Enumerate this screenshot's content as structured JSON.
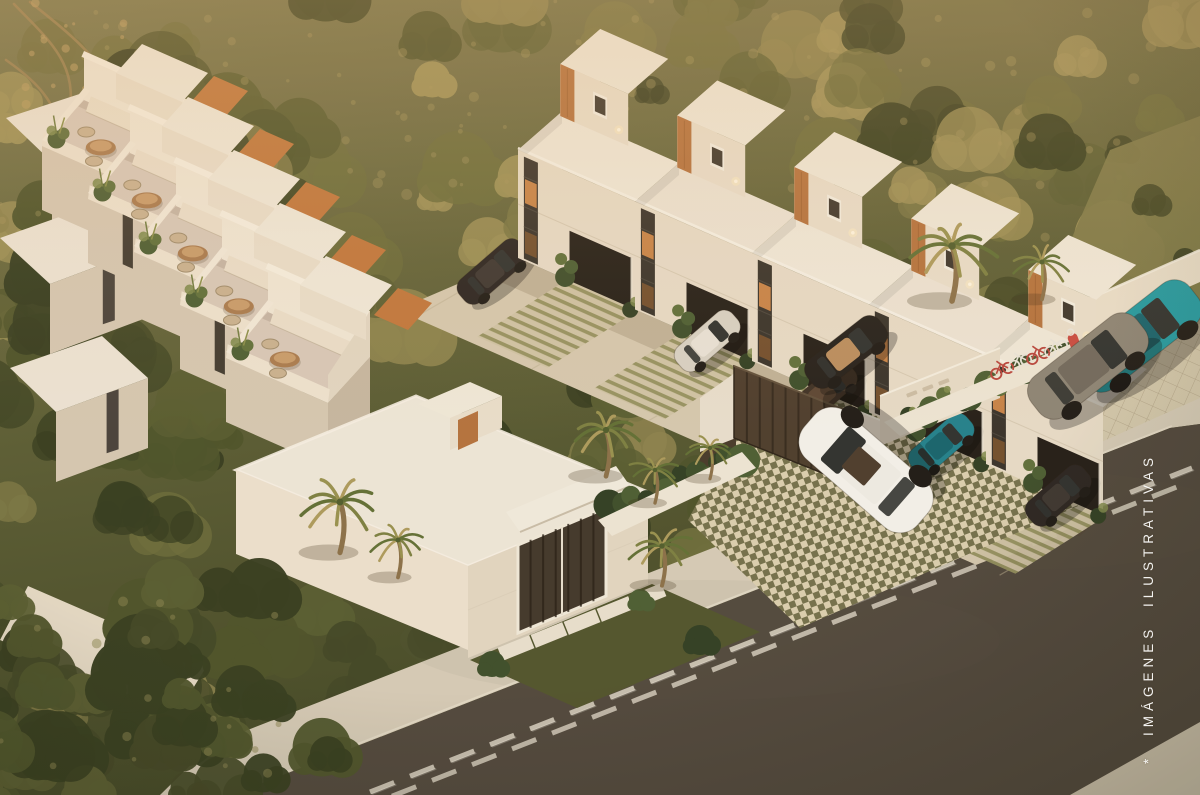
{
  "watermark": {
    "text": "* IMÁGENES ILUSTRATIVAS"
  },
  "scene": {
    "description": "Aerial dusk render of a white townhouse residential complex with rooftop terraces, carports, gated entrance and street"
  },
  "palette": {
    "forestTop": "#77744a",
    "forestMid": "#5d5f36",
    "forestDark": "#3f4524",
    "treeDark1": "#333b1e",
    "treeDark2": "#3f4524",
    "treeDark3": "#4a5129",
    "treeDark4": "#565b30",
    "treeLight1": "#6a6b3a",
    "treeLight2": "#787543",
    "treeLight3": "#8a814c",
    "treeLight4": "#9b8f56",
    "grass": "#7b7847",
    "grassDark": "#4f532c",
    "roofTop": "#ece4d6",
    "roofTop2": "#f0e9db",
    "faceLit": "#e9dfcd",
    "faceLit2": "#e7dcc9",
    "faceShade": "#d5c8b3",
    "faceShade2": "#c6b7a2",
    "wood": "#b4713d",
    "woodDark": "#8f5427",
    "glazing": "#35302a",
    "glassLit": "#d78c4a",
    "glassDim": "#8a5a2e",
    "carport": "#201b16",
    "terraceFloor": "#d8c9ba",
    "bench": "#eadfcc",
    "backWall": "#f0e7d7",
    "alley": "#d5c9b0",
    "paverLine": "#bcae93",
    "checkerLight": "#ddd3b6",
    "checkerDark": "#6c6c4a",
    "stripeBg": "#cfc3a6",
    "stripeGreen": "#8c8a57",
    "gridBg": "#d3c8ad",
    "gridLine": "#b5a88d",
    "road": "#4e463c",
    "sidewalk": "#d5cbb8",
    "sidewalk2": "#cfc5b1",
    "marking": "#e6dfd0",
    "gate": "#4a3b2c",
    "gateSlat": "#2e241a",
    "pillar": "#eae1d1",
    "wallCream": "#e9dfcc",
    "shrub1": "#2e3d22",
    "shrub2": "#3a4c2a",
    "shrub3": "#495c32",
    "shrub4": "#5d6e3a",
    "shrubLight": "#7e8a4c",
    "trunk": "#8a6f48",
    "frond1": "#5f6e34",
    "frond2": "#7b7f41",
    "frond3": "#97914f",
    "frondDry": "#ac9a5c",
    "suv": "#f4f2ec",
    "silverCar": "#d8d2c6",
    "bronzeCar": "#3c2f24",
    "tealCar": "#1f9aa3",
    "grayCar": "#8b8375",
    "darkCar": "#272220",
    "carGlass": "#2c2f2e",
    "interiorTan": "#b98d5e",
    "tableWood": "#a87a4f",
    "chairTone": "#c9b191",
    "bikeRed": "#b8433c",
    "bikeWhite": "#e9e5dc",
    "lightGlow": "#ffedc4",
    "lightCore": "#fff8e6"
  }
}
